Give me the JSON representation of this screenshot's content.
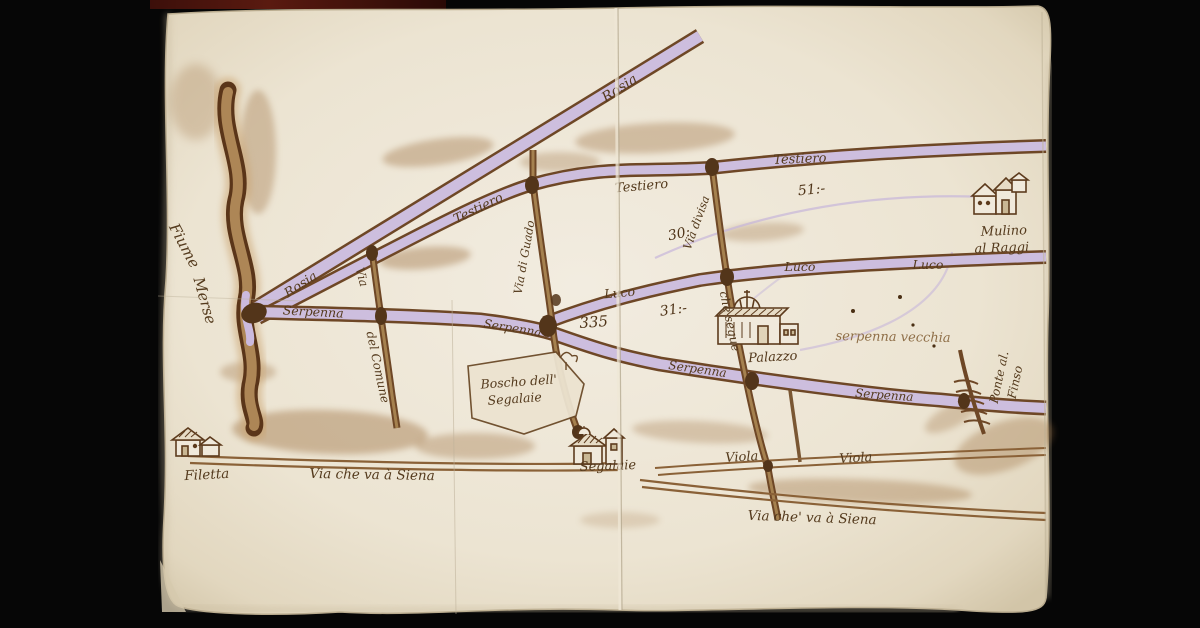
{
  "map": {
    "kind": "hand-drawn manuscript watercolor map on aged paper",
    "colors": {
      "background": "#060606",
      "paper": "#eee6d6",
      "road_fill": "#cbbade",
      "road_casing": "#6e4726",
      "ink": "#543a1d",
      "faded_ink": "#8f6f48",
      "wash": "#9c6f3f",
      "top_strip": "#5a1a10"
    }
  },
  "labels": {
    "fiume_a": "Fiume",
    "fiume_b": "Merse",
    "rosia_upper": "Rosia",
    "rosia_lower": "Rosia",
    "testiero_1": "Testiero",
    "testiero_2": "Testiero",
    "testiero_3": "Testiero",
    "luco_1": "Luco",
    "luco_2": "Luco",
    "luco_3": "Luco",
    "serpenna_1": "Serpenna",
    "serpenna_2": "Serpenna",
    "serpenna_3": "Serpenna",
    "serpenna_4": "Serpenna",
    "serpenna_vecchia": "serpenna vecchia",
    "viola_1": "Viola",
    "viola_2": "Viola",
    "via_siena_1": "Via che va à Siena",
    "via_siena_2": "Via che' va à Siena",
    "via_comune_a": "Via",
    "via_comune_b": "del Comune",
    "via_di_guado": "Via di Guado",
    "via_divisa": "Via divisa",
    "che_segue": "che segue",
    "boscho_1": "Boscho dell'",
    "boscho_2": "Segalaie",
    "palazzo": "Palazzo",
    "segalaie": "Segalaie",
    "filetta": "Filetta",
    "mulino_1": "Mulino",
    "mulino_2": "al Raggi",
    "ponte_1": "Ponte al.",
    "ponte_2": "Finso",
    "m51": "51:-",
    "m30": "30:",
    "m31": "31:-",
    "m335": "335"
  }
}
